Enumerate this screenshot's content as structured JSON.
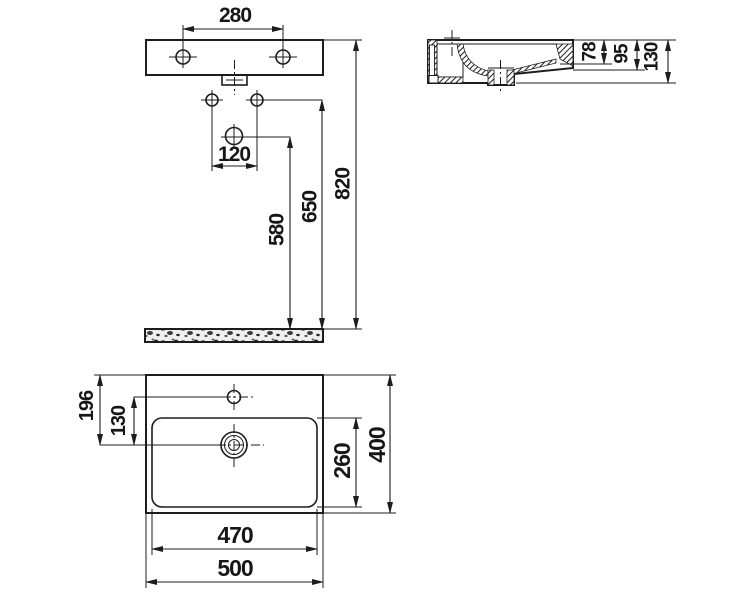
{
  "drawing": {
    "background": "#ffffff",
    "line_color": "#1d1d1d",
    "views": {
      "front": {
        "dim_tap_hole_spacing": "280",
        "dim_fixing_hole_spacing": "120",
        "dim_drain_height": "580",
        "dim_fixing_hole_height": "650",
        "dim_rim_height": "820"
      },
      "side": {
        "dim_bowl_depth": "78",
        "dim_front_edge_height": "95",
        "dim_total_height": "130"
      },
      "plan": {
        "dim_rim_to_drain": "196",
        "dim_tap_to_drain": "130",
        "dim_bowl_depth": "260",
        "dim_overall_depth": "400",
        "dim_bowl_width": "470",
        "dim_overall_width": "500"
      }
    }
  }
}
